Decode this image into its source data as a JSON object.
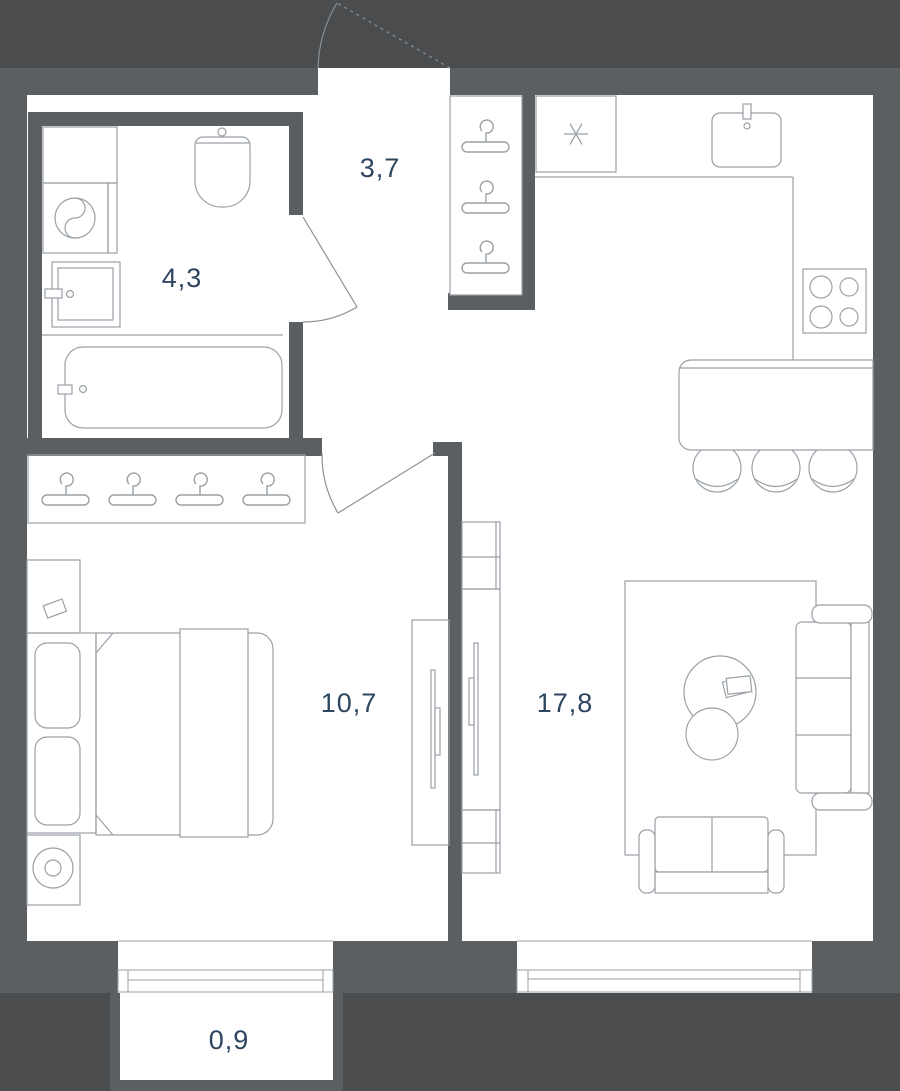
{
  "plan": {
    "type": "apartment-floor-plan",
    "rooms": {
      "bathroom": {
        "area": "4,3"
      },
      "hallway": {
        "area": "3,7"
      },
      "bedroom": {
        "area": "10,7"
      },
      "living_kitchen": {
        "area": "17,8"
      },
      "balcony": {
        "area": "0,9"
      }
    },
    "colors": {
      "background": "#4A4C4E",
      "wall": "#5C5F61",
      "floor": "#FFFFFF",
      "furniture_line": "#9AA1A6",
      "door_line": "#8B9196",
      "label_text": "#2E4560"
    },
    "icons": {
      "freezer_symbol": "✳",
      "coat_hanger": "hanger-glyph"
    }
  }
}
